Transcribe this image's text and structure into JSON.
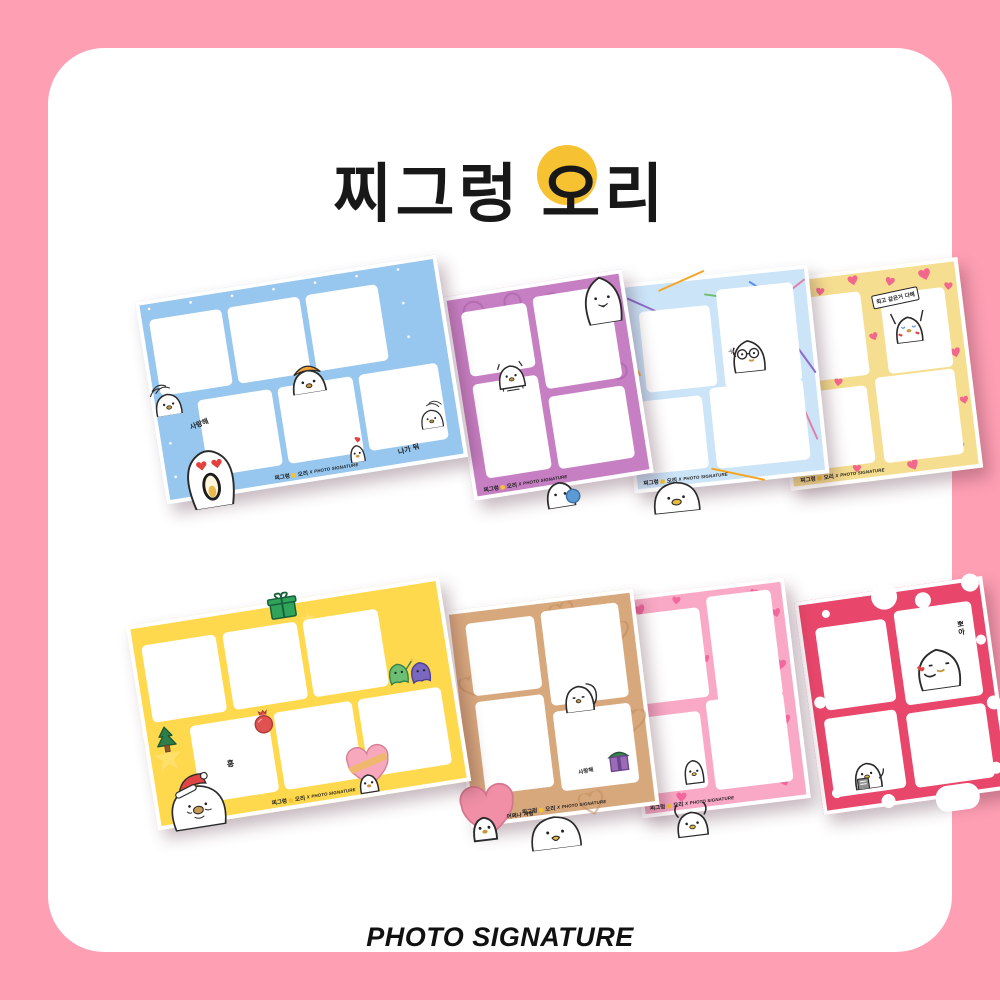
{
  "page": {
    "background_color": "#FF9FB4",
    "card_color": "#FFFFFF"
  },
  "title": {
    "prefix": "찌그렁",
    "o": "오",
    "ri": "리",
    "full": "찌그렁 오리",
    "o_circle_color": "#F7C231"
  },
  "footer": {
    "brand": "PHOTO SIGNATURE"
  },
  "branding": {
    "kr": "찌그렁",
    "duck": "오리",
    "x": "X",
    "en": "PHOTO SIGNATURE",
    "full": "찌그렁 오리 X PHOTO SIGNATURE"
  },
  "frames": [
    {
      "name": "sky-snow-blue",
      "color": "#97C6EE",
      "slots": 6,
      "captions": {
        "love": "사랑해",
        "go_away": "나가 둬"
      }
    },
    {
      "name": "purple-stamps",
      "color": "#C77FC3",
      "slots": 4,
      "captions": {}
    },
    {
      "name": "blue-streamers",
      "color": "#CBE4F8",
      "slots": 4,
      "captions": {}
    },
    {
      "name": "yellow-hearts",
      "color": "#F6DE90",
      "heart_color": "#F2688C",
      "slots": 4,
      "captions": {
        "sign": "최고 같은거 다해"
      }
    },
    {
      "name": "yellow-christmas",
      "color": "#FFD94D",
      "slots": 6,
      "captions": {
        "hmph": "흥"
      }
    },
    {
      "name": "tan-hearts",
      "color": "#D8A87D",
      "slots": 4,
      "captions": {
        "love_small": "사랑해",
        "oh_love": "어쩌나 사랑"
      }
    },
    {
      "name": "pink-hearts",
      "color": "#F9A9C5",
      "heart_color": "#F2689E",
      "slots": 4,
      "captions": {}
    },
    {
      "name": "red-dots",
      "color": "#E8476B",
      "slots": 4,
      "captions": {
        "kiss": "뽀아"
      }
    }
  ]
}
